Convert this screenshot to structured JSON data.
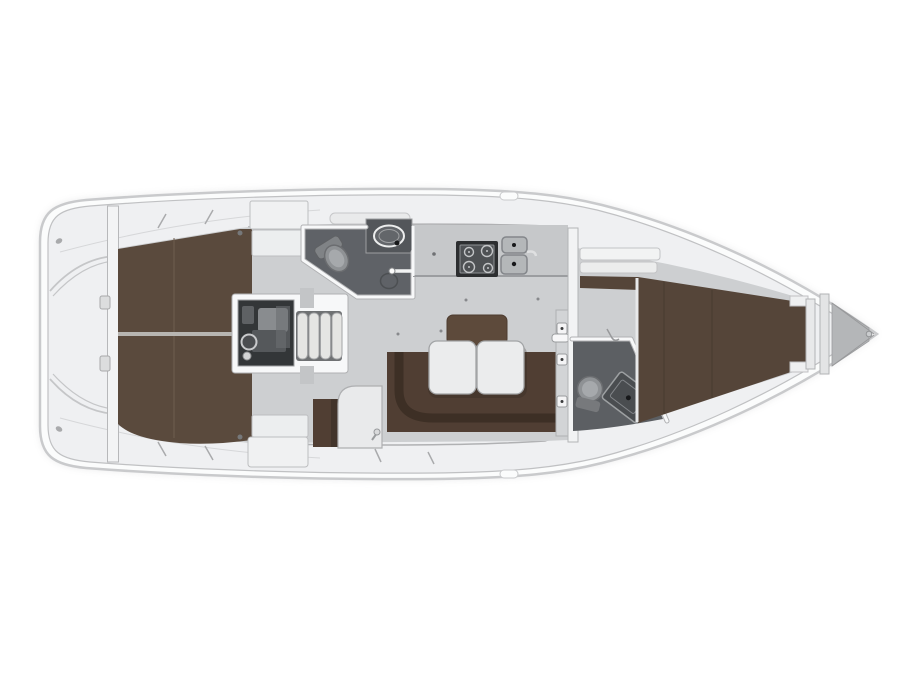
{
  "figure": {
    "type": "yacht-interior-floor-plan",
    "orientation": "bow-right"
  },
  "regions": {
    "hull": "Sailing yacht hull (top view, bow to the right)",
    "transom": "Transom and cockpit platform",
    "aft_cabin_port": "Aft cabin berth (port)",
    "aft_cabin_stbd": "Aft cabin berth (starboard)",
    "aft_lockers": "Aft cabin lockers",
    "engine": "Engine compartment",
    "steps": "Companionway steps",
    "aft_head": "Aft head with toilet and washbasin",
    "galley": "Galley with stove and twin sinks",
    "chart_table": "Chart table",
    "nav_seat": "Navigator seat",
    "settee": "U-shaped saloon settee",
    "table": "Folding saloon table",
    "fwd_head": "Forward head with toilet and shower",
    "fwd_cabin": "Forward cabin V-berth",
    "anchor_locker": "Anchor locker",
    "bow": "Bow tip"
  },
  "colors": {
    "page_bg": "#ffffff",
    "hull_fill": "#fbfcfc",
    "hull_line": "#c9cacc",
    "inner_line": "#c0c1c3",
    "deck_fill": "#eff0f2",
    "wall_white": "#f7f8f9",
    "wall_edge": "#b0b1b3",
    "floor_gray": "#cdcfd1",
    "berth_brown": "#5a4a3d",
    "berth_seam": "#6e5d4e",
    "v_berth": "#554539",
    "v_seam": "#483b30",
    "settee_brown": "#503e33",
    "settee_edge": "#3d2f25",
    "table_center": "#5d4a3b",
    "table_leaf": "#ebeced",
    "leaf_edge": "#a2a4a6",
    "leaf_shadow": "rgba(45,38,32,0.28)",
    "counter": "#c6c8ca",
    "counter_edge": "#9b9da0",
    "stove_dark": "#2c2e30",
    "stove_inner": "#4e5154",
    "stove_ring": "#c3c5c7",
    "sink_fill": "#b4b7b9",
    "sink_edge": "#83868a",
    "drain_dark": "#17181a",
    "head_floor": "#5f6267",
    "head_floor_fwd": "#5c5f63",
    "vanity_dark": "#53565a",
    "fixture_gray": "#8f9295",
    "fixture_edge": "#6b6d70",
    "fixture_light": "#a6a9ac",
    "engine_bg": "#333638",
    "engine_mid": "#55585b",
    "engine_light": "#898c8f",
    "engine_ring": "#c8c9cb",
    "steps_gap": "#6f7173",
    "step_fill": "#e5e5e3",
    "step_edge": "#a2a3a5",
    "cabinet_fill": "#f0f1f2",
    "cabinet_edge": "#bdbec0",
    "divider_light": "#b7b5b1",
    "metal_gray": "#a9aaac",
    "locker_gray": "#b4b6b8",
    "detail_line": "#98999b",
    "dot_dark": "#76787a",
    "shadow_halo": "#c7c8ca"
  }
}
